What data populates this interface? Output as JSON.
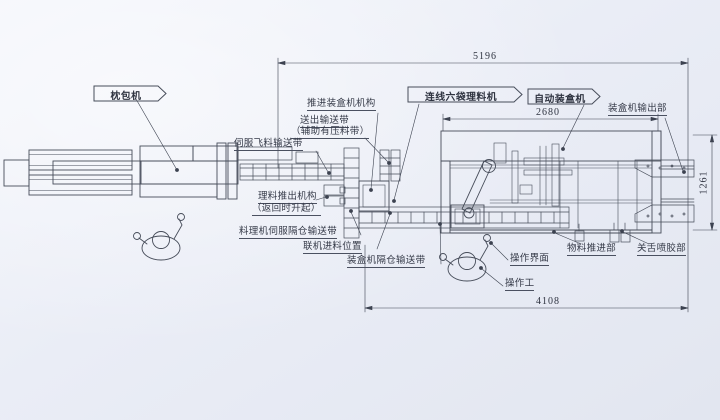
{
  "drawing": {
    "background_color": "#eaedf6",
    "line_color": "#474d5a",
    "flags": {
      "pillow_packer": "枕包机",
      "inline_six_bag_machine": "连线六袋理料机",
      "auto_cartoner": "自动装盒机"
    },
    "labels": {
      "push_into_cartoner_mechanism": "推进装盒机机构",
      "outfeed_belt_line1": "送出输送带",
      "outfeed_belt_line2": "（辅助有压料带）",
      "cartoner_output_section": "装盒机输出部",
      "servo_fly_feed_belt": "伺服飞料输送带",
      "pushout_mechanism_line1": "理料推出机构",
      "pushout_mechanism_line2": "（返回时升起）",
      "servo_compartment_belt": "料理机伺服隔仓输送带",
      "inline_feed_position": "联机进料位置",
      "cartoner_compartment_belt": "装盒机隔仓输送带",
      "operation_interface": "操作界面",
      "material_pusher_section": "物料推进部",
      "tongue_glue_section": "关舌喷胶部",
      "operator": "操作工"
    },
    "dimensions": {
      "overall_length": "5196",
      "cartoner_length": "2680",
      "machine_height": "1261",
      "working_length": "4108"
    }
  }
}
